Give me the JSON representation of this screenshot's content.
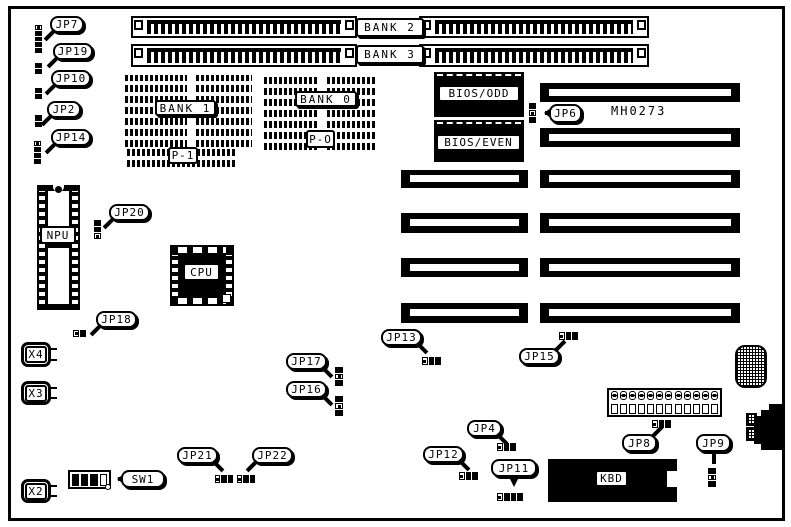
{
  "board": {
    "part_number": "MH0273",
    "colors": {
      "ink": "#000000",
      "paper": "#ffffff"
    }
  },
  "callouts": {
    "jp2": "JP2",
    "jp4": "JP4",
    "jp6": "JP6",
    "jp7": "JP7",
    "jp8": "JP8",
    "jp9": "JP9",
    "jp10": "JP10",
    "jp11": "JP11",
    "jp12": "JP12",
    "jp13": "JP13",
    "jp14": "JP14",
    "jp15": "JP15",
    "jp16": "JP16",
    "jp17": "JP17",
    "jp18": "JP18",
    "jp19": "JP19",
    "jp20": "JP20",
    "jp21": "JP21",
    "jp22": "JP22",
    "sw1": "SW1"
  },
  "components": {
    "bank0": "BANK 0",
    "bank1": "BANK 1",
    "bank2": "BANK 2",
    "bank3": "BANK 3",
    "p1": "P-1",
    "p0": "P-O",
    "bios_odd": "BIOS/ODD",
    "bios_even": "BIOS/EVEN",
    "npu": "NPU",
    "cpu": "CPU",
    "kbd": "KBD",
    "x2": "X2",
    "x3": "X3",
    "x4": "X4"
  }
}
